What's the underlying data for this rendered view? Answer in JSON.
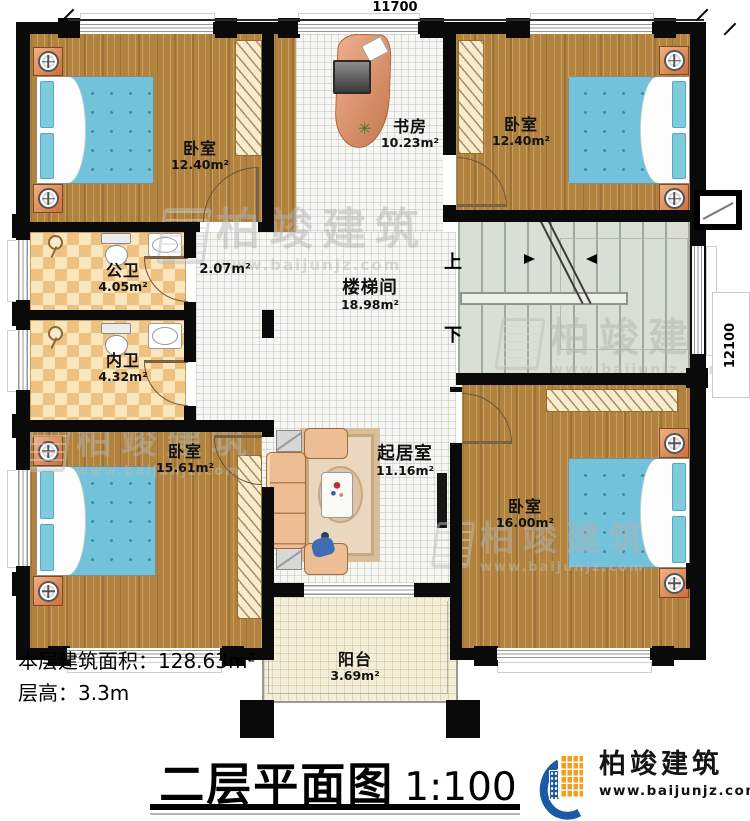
{
  "plan": {
    "title": "二层平面图",
    "scale": "1:100",
    "footer": {
      "area_label": "本层建筑面积：",
      "area_value": "128.63m²",
      "height_label": "层高：",
      "height_value": "3.3m"
    },
    "dimensions": {
      "width": "11700",
      "height": "12100"
    },
    "stair_labels": {
      "up": "上",
      "down": "下"
    }
  },
  "rooms": [
    {
      "id": "bedroom-top-left",
      "name": "卧室",
      "area": "12.40m²"
    },
    {
      "id": "study",
      "name": "书房",
      "area": "10.23m²"
    },
    {
      "id": "bedroom-top-right",
      "name": "卧室",
      "area": "12.40m²"
    },
    {
      "id": "bath-public",
      "name": "公卫",
      "area": "4.05m²"
    },
    {
      "id": "hall-small",
      "name": "",
      "area": "2.07m²"
    },
    {
      "id": "bath-private",
      "name": "内卫",
      "area": "4.32m²"
    },
    {
      "id": "stair-hall",
      "name": "楼梯间",
      "area": "18.98m²"
    },
    {
      "id": "bedroom-bottom-left",
      "name": "卧室",
      "area": "15.61m²"
    },
    {
      "id": "living",
      "name": "起居室",
      "area": "11.16m²"
    },
    {
      "id": "bedroom-bottom-right",
      "name": "卧室",
      "area": "16.00m²"
    },
    {
      "id": "balcony",
      "name": "阳台",
      "area": "3.69m²"
    }
  ],
  "brand": {
    "name": "柏竣建筑",
    "site": "www.baijunjz.com"
  },
  "watermark": {
    "name": "柏竣建筑",
    "site": "www.baijunjz.com"
  },
  "colors": {
    "wall": "#0a0a0a",
    "wood_floor": "#b1833f",
    "tile_floor": "#f6f6f3",
    "checker_floor": "#eec181",
    "stair_floor": "#d9dfd4",
    "balcony_floor": "#f3eed8",
    "bed_blue": "#72c3da",
    "brand_orange": "#f59d20",
    "brand_blue": "#1b5aa5"
  }
}
